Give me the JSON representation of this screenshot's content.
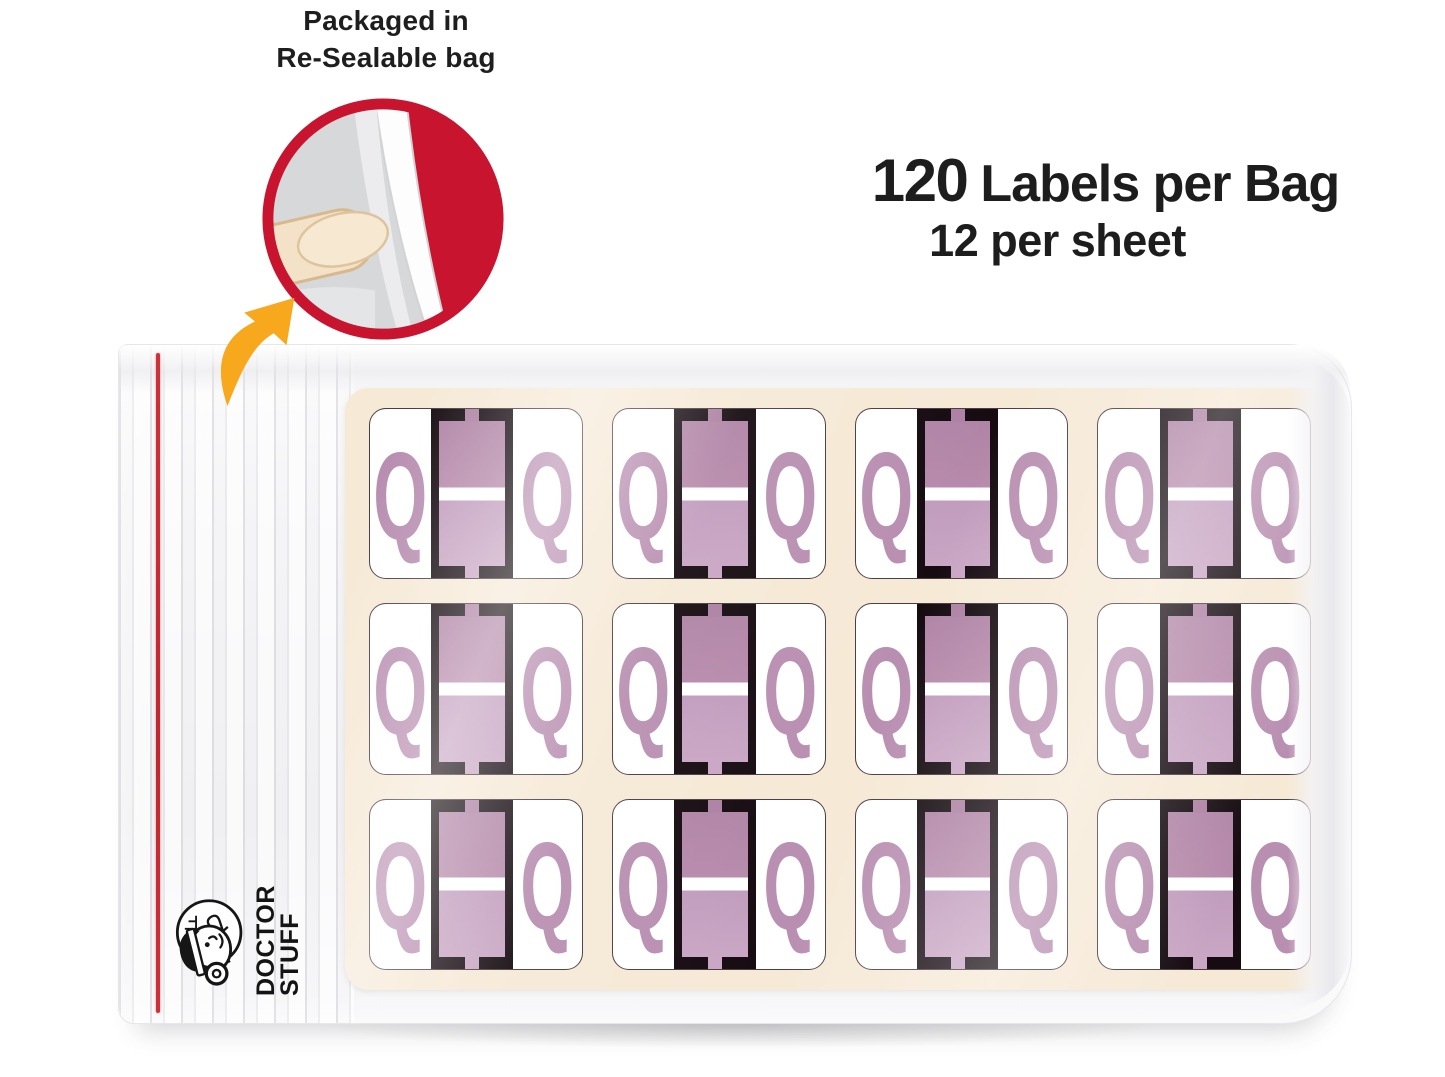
{
  "caption": {
    "line1": "Packaged in",
    "line2": "Re-Sealable bag"
  },
  "headline": {
    "count": "120",
    "rest": "Labels per Bag",
    "line2": "12 per sheet"
  },
  "sheet": {
    "letter": "Q",
    "labels": [
      "Q",
      "Q",
      "Q",
      "Q",
      "Q",
      "Q",
      "Q",
      "Q",
      "Q",
      "Q",
      "Q",
      "Q"
    ]
  },
  "logo": {
    "line1": "DOCTOR",
    "line2": "STUFF"
  },
  "colors": {
    "accent_red": "#c8142e",
    "arrow_orange": "#f7a81c",
    "red_line": "#cf3038",
    "sheet_cream": "#f6e9d6",
    "band_black": "#150b10",
    "label_purple": "#b486a8",
    "label_purple_light": "#c9a6c4",
    "q_color": "#b98fb1",
    "text_dark": "#1d1d1d"
  }
}
